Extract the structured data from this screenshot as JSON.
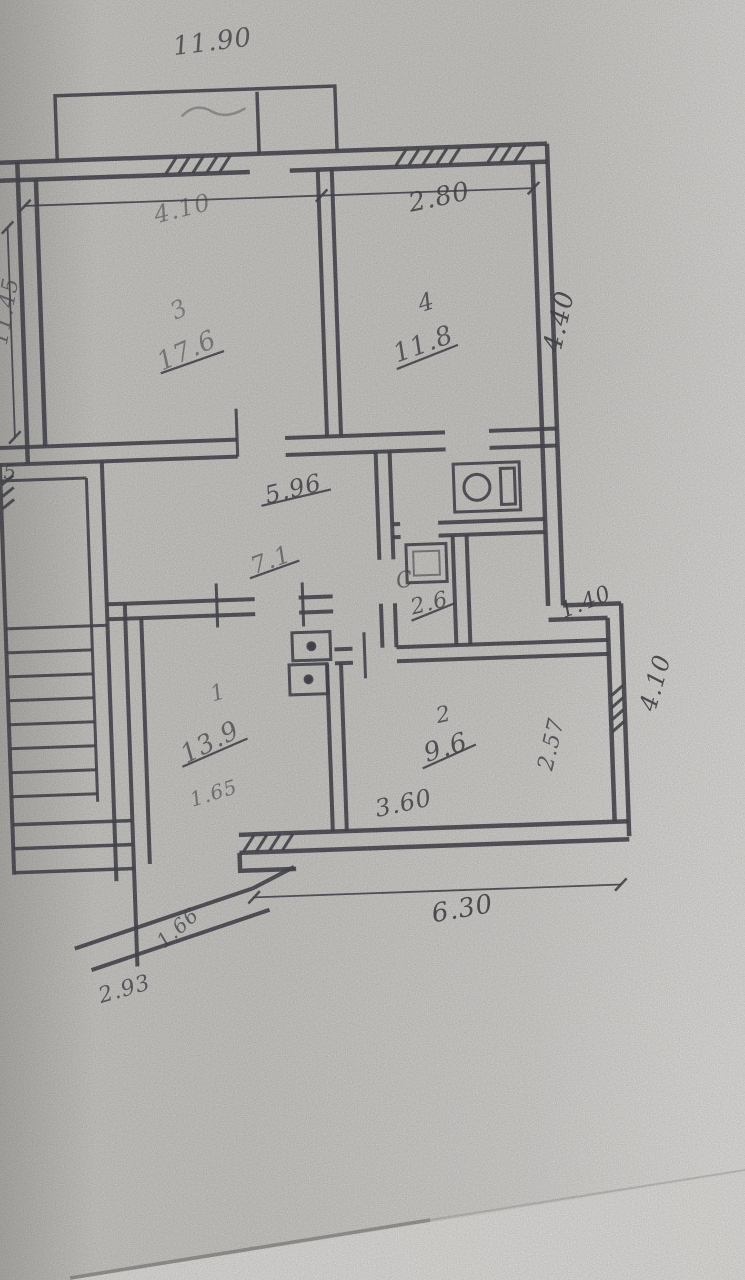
{
  "colors": {
    "paper": "#b9b7b3",
    "ink": "#2e2e36",
    "table": "#f2f1ee"
  },
  "floor_plan": {
    "rooms": {
      "room3": {
        "number": "3",
        "area": "17.6"
      },
      "room4": {
        "number": "4",
        "area": "11.8"
      },
      "hall": {
        "area": "7.1"
      },
      "bathroom": {
        "number": "С",
        "area": "2.6"
      },
      "room1": {
        "number": "1",
        "area": "13.9"
      },
      "room2": {
        "number": "2",
        "area": "9.6"
      }
    },
    "dimensions": {
      "top_width": "11.90",
      "top_left_span": "4.10",
      "top_right_span": "2.80",
      "left_height": "11.45",
      "right_upper_height": "4.40",
      "hall_width": "5.96",
      "niche_width": "1.40",
      "right_lower_height": "4.10",
      "room1_lower": "1.65",
      "room2_bottom_width": "3.60",
      "room2_right_height": "2.57",
      "bottom_width": "6.30",
      "stair_diagonal": "1.66",
      "stair_bottom": "2.93",
      "left_window": "5"
    }
  }
}
